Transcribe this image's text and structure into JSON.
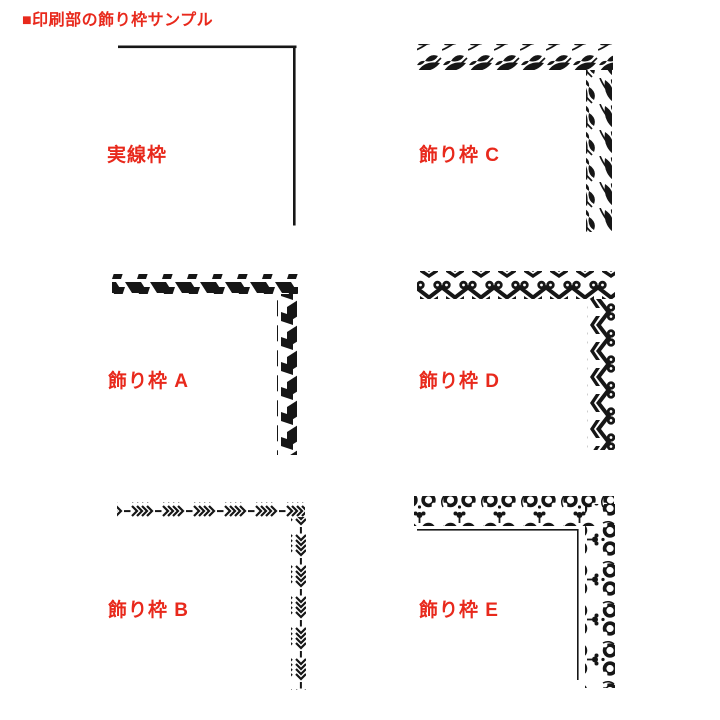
{
  "title": "■印刷部の飾り枠サンプル",
  "colors": {
    "accent_red": "#e8291c",
    "ink_black": "#161616",
    "background": "#ffffff"
  },
  "samples": [
    {
      "id": "solid",
      "label": "実線枠",
      "pattern": "solid-line-corner"
    },
    {
      "id": "c",
      "label": "飾り枠 C",
      "pattern": "leaf-vine-corner"
    },
    {
      "id": "a",
      "label": "飾り枠 A",
      "pattern": "twisted-ribbon-corner"
    },
    {
      "id": "d",
      "label": "飾り枠 D",
      "pattern": "heart-scroll-corner"
    },
    {
      "id": "b",
      "label": "飾り枠 B",
      "pattern": "arrow-chevron-corner"
    },
    {
      "id": "e",
      "label": "飾り枠 E",
      "pattern": "floral-scroll-corner"
    }
  ]
}
